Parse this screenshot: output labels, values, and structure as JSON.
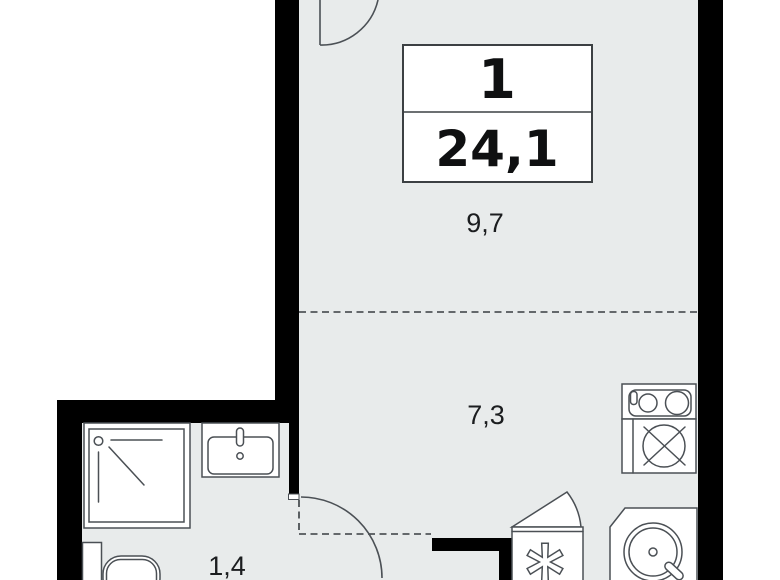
{
  "plan": {
    "type": "apartment-floor-plan",
    "unit_box": {
      "rooms": "1",
      "area_total": "24,1"
    },
    "zones": [
      {
        "id": "living",
        "area_label": "9,7"
      },
      {
        "id": "kitchen",
        "area_label": "7,3"
      },
      {
        "id": "hall",
        "area_label": "1,4"
      }
    ],
    "fixtures": [
      "shower-tray",
      "bathroom-sink",
      "toilet",
      "stove-two-burner",
      "kitchen-sink",
      "washing-machine",
      "refrigerator"
    ],
    "doors": [
      "top-door-swing",
      "hall-door-swing",
      "refrigerator-door-swing"
    ],
    "colors": {
      "wall": "#000000",
      "floor": "#e8ebeb",
      "fixture_line": "#4b5055",
      "label_border": "#3c4043",
      "text": "#0f1011",
      "background": "#ffffff"
    }
  }
}
